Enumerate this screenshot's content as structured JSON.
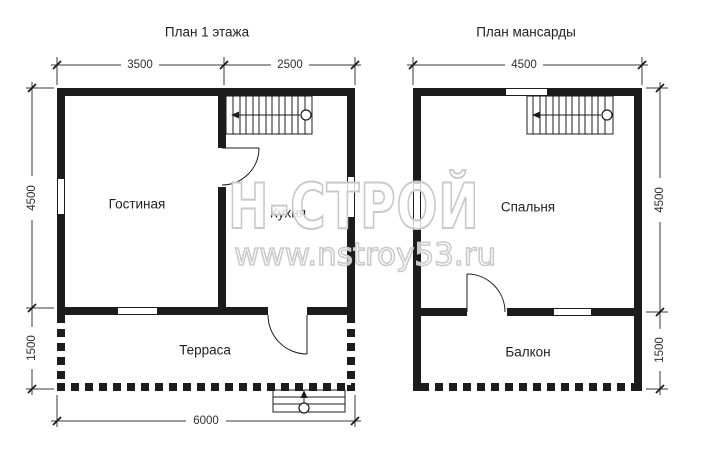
{
  "colors": {
    "ink": "#1c1c1c",
    "watermark": "#c9c9c9",
    "background": "#ffffff"
  },
  "plans": [
    {
      "title": "План 1 этажа",
      "rooms": {
        "living": "Гостиная",
        "kitchen": "Кухня",
        "terrace": "Терраса"
      },
      "dims": {
        "top_left": "3500",
        "top_right": "2500",
        "side_upper": "4500",
        "side_lower": "1500",
        "bottom": "6000"
      }
    },
    {
      "title": "План мансарды",
      "rooms": {
        "bedroom": "Спальня",
        "balcony": "Балкон"
      },
      "dims": {
        "top": "4500",
        "side_upper": "4500",
        "side_lower": "1500"
      }
    }
  ],
  "watermark": {
    "brand": "Н-СТРОЙ",
    "url": "www.nstroy53.ru"
  }
}
